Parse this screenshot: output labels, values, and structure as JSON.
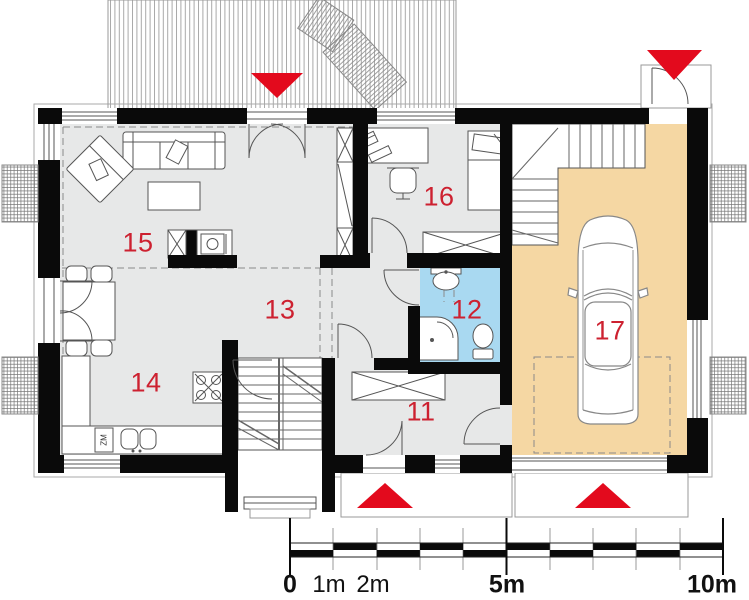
{
  "plan": {
    "type": "house-ground-floor-plan",
    "rooms": [
      {
        "number": "11"
      },
      {
        "number": "12"
      },
      {
        "number": "13"
      },
      {
        "number": "14"
      },
      {
        "number": "15"
      },
      {
        "number": "16"
      },
      {
        "number": "17"
      }
    ],
    "kitchen": {
      "dishwasher_label": "ZM"
    },
    "scale_bar": {
      "ticks": [
        {
          "label": "0",
          "bold": true
        },
        {
          "label": "1m",
          "bold": false
        },
        {
          "label": "2m",
          "bold": false
        },
        {
          "label": "5m",
          "bold": true
        },
        {
          "label": "10m",
          "bold": true
        }
      ]
    },
    "entrance_markers": [
      {
        "location": "terrace-top",
        "direction": "down"
      },
      {
        "location": "garage-side-top",
        "direction": "down"
      },
      {
        "location": "front-door-bottom",
        "direction": "up"
      },
      {
        "location": "garage-door-bottom",
        "direction": "up"
      }
    ],
    "fixtures": [
      "sofa",
      "armchair",
      "coffee-table",
      "fireplace",
      "tall-cabinet",
      "dining-table",
      "kitchen-counter",
      "kitchen-sink",
      "hob",
      "dishwasher",
      "desk",
      "computer",
      "office-chair",
      "bed",
      "wardrobe",
      "washbasin",
      "shower",
      "toilet",
      "staircase",
      "garage-staircase",
      "car",
      "deck-lounger",
      "light-well"
    ],
    "colors": {
      "wall": "#0a0a0a",
      "room_floor": "#e7e8e8",
      "garage_floor": "#f5d7a3",
      "bathroom_floor": "#a9d9f1",
      "entrance_marker": "#e30a1d",
      "room_number": "#cd2130",
      "linework": "#555555"
    }
  }
}
